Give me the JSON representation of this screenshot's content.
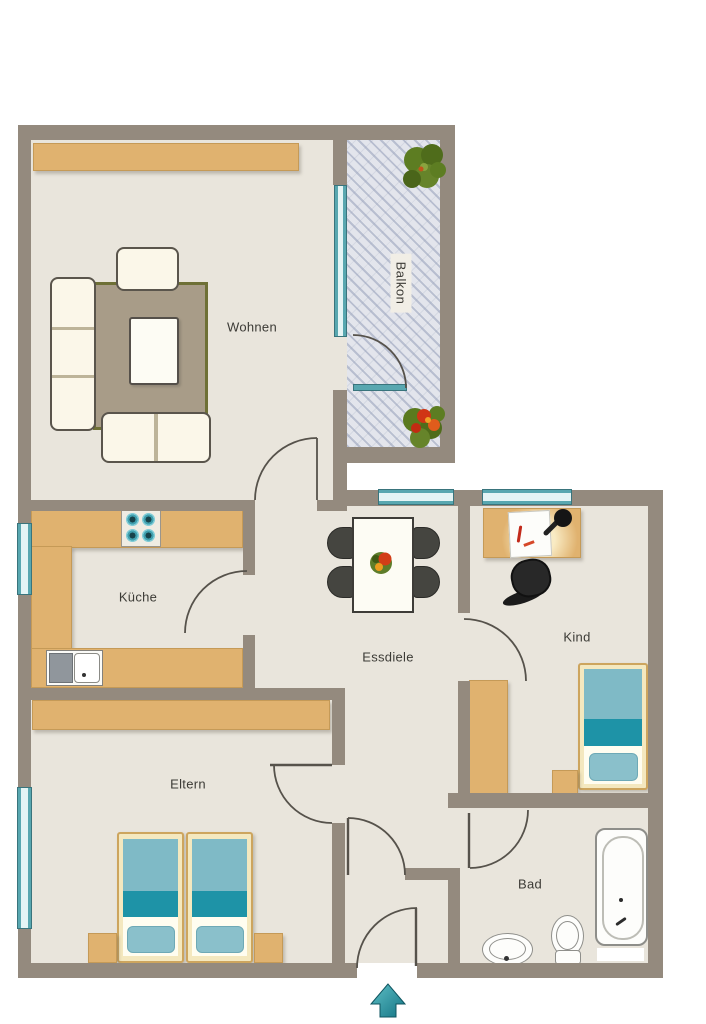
{
  "rooms": {
    "wohnen": {
      "label": "Wohnen"
    },
    "balkon": {
      "label": "Balkon"
    },
    "kueche": {
      "label": "Küche"
    },
    "essdiele": {
      "label": "Essdiele"
    },
    "kind": {
      "label": "Kind"
    },
    "eltern": {
      "label": "Eltern"
    },
    "bad": {
      "label": "Bad"
    }
  },
  "icons": {
    "entrance_arrow": "up-arrow",
    "plants": [
      "green-plant",
      "red-flower-plant"
    ],
    "table_decoration": "flower-centerpiece",
    "desk_items": [
      "paper-sheet",
      "desk-lamp"
    ]
  },
  "colors": {
    "wall": "#948a7e",
    "floor": "#e9e5dc",
    "wood": "#e0b26f",
    "teal-light": "#7fbac6",
    "teal-dark": "#1e93a7",
    "window": "#58a7b0",
    "arrow": "#2f9aa6"
  }
}
